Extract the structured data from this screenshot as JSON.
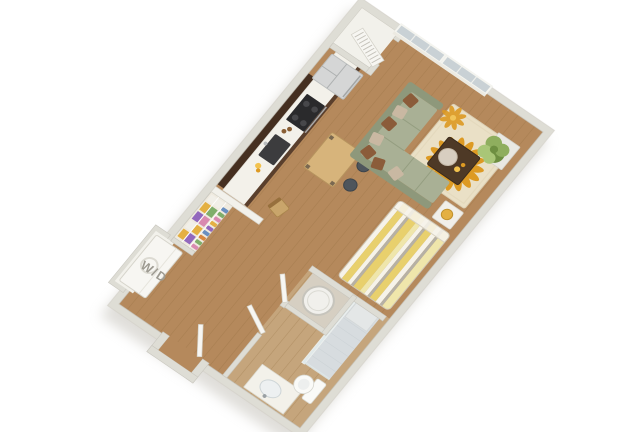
{
  "scene": {
    "type": "3d_floorplan_rendering",
    "subject": "studio apartment",
    "background": "#ffffff"
  },
  "labels": {
    "washer_dryer": "W/D"
  },
  "rooms": [
    "kitchen",
    "living-area",
    "sleeping-area",
    "bathroom",
    "entry",
    "wardrobe-closet",
    "laundry-nook",
    "utility-closet"
  ],
  "furnishings": [
    "refrigerator",
    "range-cooktop",
    "kitchen-sink",
    "upper-cabinets",
    "dining-table",
    "stools",
    "desk-chair",
    "sectional-sofa",
    "throw-pillows",
    "coffee-table",
    "sunburst-area-rug",
    "potted-plant",
    "striped-bed",
    "nightstand",
    "wardrobe-shelves",
    "washer-dryer",
    "bathroom-vanity",
    "toilet",
    "shower",
    "water-heater",
    "windows",
    "entry-door",
    "louvered-closet-door",
    "bathroom-door"
  ],
  "colors": {
    "floor": "#b5895c",
    "floorSeam": "#8f6a3c",
    "bath": "#c9ad85",
    "wall": "#deddd5",
    "wallEdge": "#c2c0b8",
    "wallBright": "#f2f1eb",
    "counter": "#f3f1ea",
    "cabinet": "#452f20",
    "cabinetFront": "#5a3f2c",
    "sinkDark": "#3c3c3e",
    "cooktop": "#2a2a2c",
    "fridge": "#d5d6d6",
    "sofa": "#a9b095",
    "sofaDark": "#8e987b",
    "pillowBrown": "#8b5c3a",
    "pillowTan": "#c9b8a2",
    "dining": "#d7b47b",
    "diningLeg": "#6a5a49",
    "stool": "#4e555c",
    "rug": "#eae0c6",
    "petal": "#dd9a23",
    "petalLight": "#f2c24e",
    "petalCore": "#b07614",
    "coffee": "#4e3926",
    "tray": "#d8cec0",
    "bedYellow": "#e8d06d",
    "bedWhite": "#f6f3e9",
    "bedGray": "#b6b1a5",
    "bedPale": "#efe6ab",
    "plantA": "#8fae5e",
    "plantB": "#a9c677",
    "plantC": "#6e8f41",
    "planter": "#e9e8e2",
    "glass": "#c9d1d5",
    "frame": "#f4f4ef",
    "door": "#f7f6f2",
    "porcelain": "#fafaf7",
    "showerFloor": "#d7dcdf",
    "heater": "#f1f0ec",
    "closetBack": "#efeadf",
    "itemYellow": "#e4b042",
    "itemPurple": "#9268bd",
    "itemPink": "#d98ab0",
    "itemGreen": "#7fae6a",
    "itemOrange": "#d9883f",
    "itemBlue": "#6a8fc0",
    "itemWhite": "#f1efe8",
    "chairWood": "#c9a56b",
    "chairWoodDark": "#97703d",
    "nightstand": "#f1efe9",
    "labelColor": "#9d9a91",
    "shadowColor": "#c6c3bb"
  }
}
